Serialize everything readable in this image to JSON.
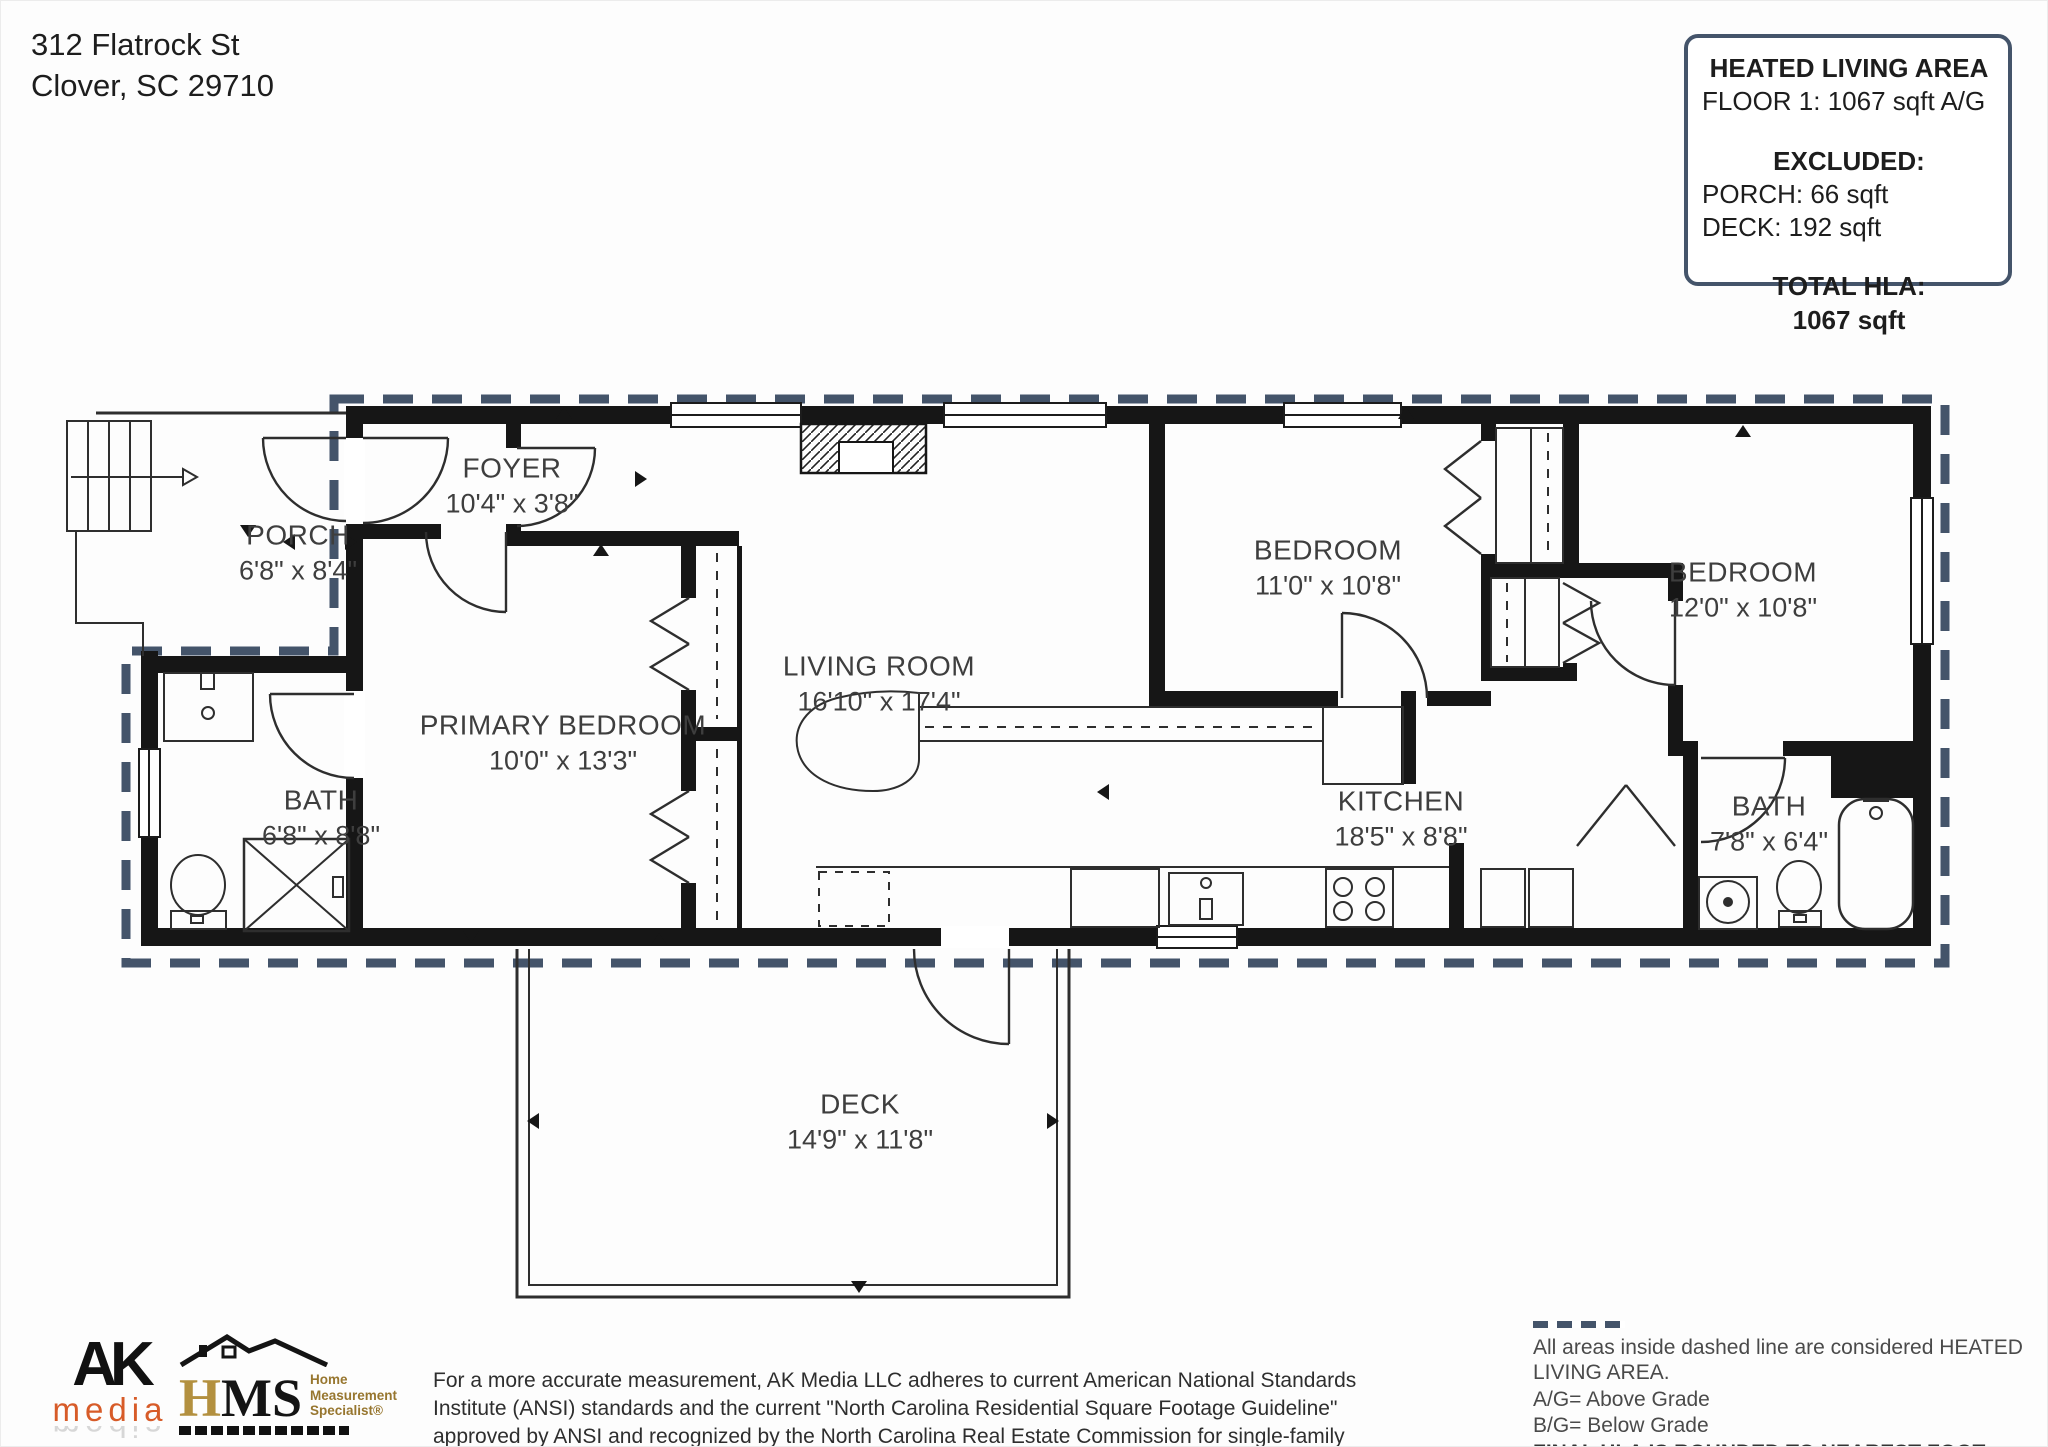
{
  "address": {
    "line1": "312 Flatrock St",
    "line2": "Clover, SC  29710"
  },
  "hla_box": {
    "title": "HEATED LIVING AREA",
    "floor_line": "FLOOR 1: 1067 sqft  A/G",
    "excluded_title": "EXCLUDED:",
    "excluded_porch": "PORCH: 66 sqft",
    "excluded_deck": "DECK: 192 sqft",
    "total_title": "TOTAL HLA:",
    "total_value": "1067 sqft"
  },
  "rooms": {
    "porch": {
      "name": "PORCH",
      "dims": "6'8\" x 8'4\""
    },
    "foyer": {
      "name": "FOYER",
      "dims": "10'4\" x 3'8\""
    },
    "primary": {
      "name": "PRIMARY BEDROOM",
      "dims": "10'0\" x 13'3\""
    },
    "bath1": {
      "name": "BATH",
      "dims": "6'8\" x 8'8\""
    },
    "living": {
      "name": "LIVING ROOM",
      "dims": "16'10\" x 17'4\""
    },
    "bedroom1": {
      "name": "BEDROOM",
      "dims": "11'0\" x 10'8\""
    },
    "bedroom2": {
      "name": "BEDROOM",
      "dims": "12'0\" x 10'8\""
    },
    "kitchen": {
      "name": "KITCHEN",
      "dims": "18'5\" x 8'8\""
    },
    "bath2": {
      "name": "BATH",
      "dims": "7'8\" x 6'4\""
    },
    "deck": {
      "name": "DECK",
      "dims": "14'9\" x 11'8\""
    }
  },
  "footer": {
    "ak_logo": {
      "line1": "AK",
      "line2": "media"
    },
    "hms_logo": {
      "abbr_h": "H",
      "abbr_ms": "MS",
      "tag1": "Home",
      "tag2": "Measurement",
      "tag3": "Specialist®"
    },
    "disclaimer": "For a more accurate measurement, AK Media LLC adheres to current American National Standards Institute (ANSI) standards and the current \"North Carolina Residential Square Footage Guideline\" approved by ANSI and recognized by the North Carolina Real Estate Commission for single-family dwellings and townhouses for both North and South Carolina.",
    "legend": {
      "note": "All areas inside dashed line are considered HEATED LIVING AREA.",
      "ag": "A/G= Above Grade",
      "bg": "B/G= Below Grade",
      "final": "FINAL HLA IS ROUNDED TO NEAREST FOOT"
    }
  },
  "colors": {
    "wall": "#161616",
    "boundary": "#44546a",
    "ak_orange": "#d75b28",
    "hms_gold": "#b3903f"
  }
}
